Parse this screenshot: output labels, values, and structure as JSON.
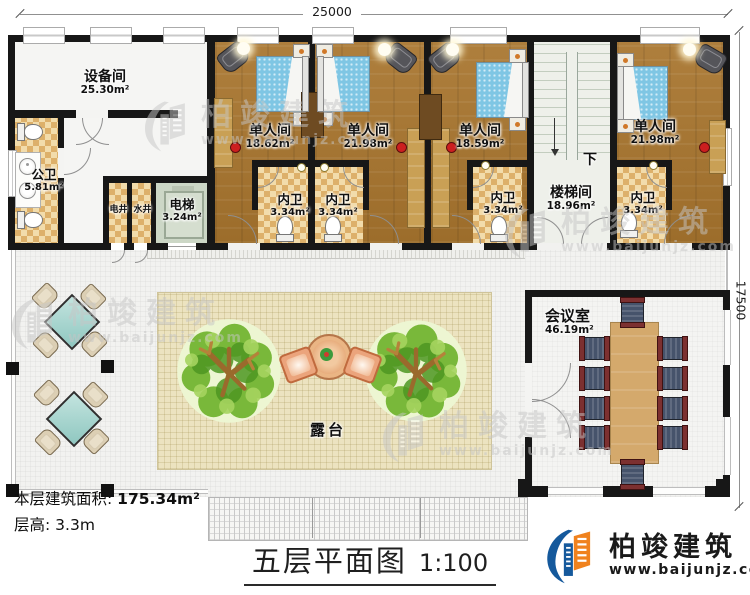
{
  "dims": {
    "top": "25000",
    "right": "17500"
  },
  "rooms": {
    "shebeijian": {
      "name": "设备间",
      "area": "25.30m²"
    },
    "gongwei": {
      "name": "公卫",
      "area": "5.81m²"
    },
    "dianjing": {
      "name": "电井"
    },
    "shuijing": {
      "name": "水井"
    },
    "dianti": {
      "name": "电梯",
      "area": "3.24m²"
    },
    "bedroom1": {
      "name": "单人间",
      "area": "18.62m²"
    },
    "bedroom2": {
      "name": "单人间",
      "area": "21.98m²"
    },
    "bedroom3": {
      "name": "单人间",
      "area": "18.59m²"
    },
    "bedroom4": {
      "name": "单人间",
      "area": "21.98m²"
    },
    "neiwei": {
      "name": "内卫",
      "area": "3.34m²"
    },
    "loutijian": {
      "name": "楼梯间",
      "area": "18.96m²",
      "down": "下"
    },
    "huiyishi": {
      "name": "会议室",
      "area": "46.19m²"
    },
    "lutai": {
      "name": "露台"
    }
  },
  "footer": {
    "area_label": "本层建筑面积:",
    "area_value": "175.34m²",
    "height_label": "层高:",
    "height_value": "3.3m",
    "title": "五层平面图",
    "scale": "1:100"
  },
  "brand": {
    "name": "柏竣建筑",
    "site": "www.baijunjz.com"
  },
  "colors": {
    "wall": "#171717",
    "wood_floor": "#a8752e",
    "checker_tile": "#ddb06a",
    "terrace": "#f2f2f0",
    "platform": "#ece3c0",
    "elevator": "#ccd7c6",
    "stair": "#eef0ea",
    "bed_blue": "#7fc6e4",
    "tree_green": "#79b83a",
    "logo_blue": "#15599c",
    "logo_orange": "#f0821e",
    "watermark_gray": "#c6c6c6"
  }
}
